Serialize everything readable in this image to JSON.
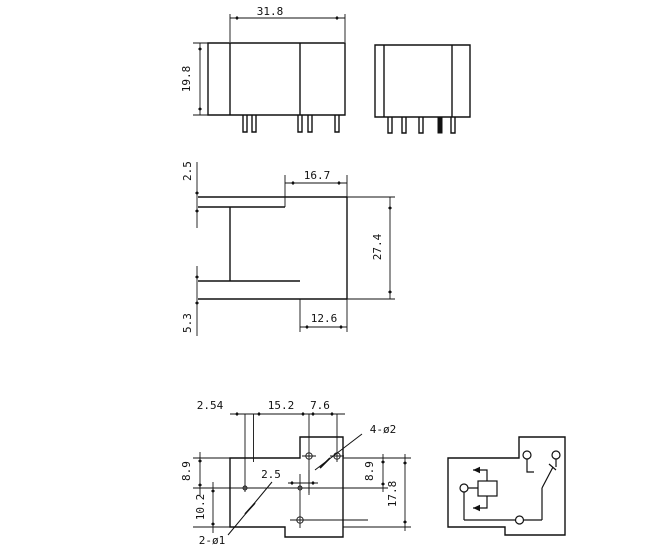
{
  "drawing": {
    "front_view": {
      "width": "31.8",
      "height": "19.8"
    },
    "profile_view": {
      "top_flange_thickness": "2.5",
      "top_width": "16.7",
      "depth": "27.4",
      "bottom_width": "12.6",
      "bottom_flange_thickness": "5.3"
    },
    "pcb_layout": {
      "pin_pitch": "2.54",
      "pin_span": "15.2",
      "hole_span": "7.6",
      "mounting_holes_note": "4-ø2",
      "pin_holes_note": "2-ø1",
      "offset": "2.5",
      "left_upper": "8.9",
      "left_lower": "10.2",
      "right_upper": "8.9",
      "right_total": "17.8"
    }
  }
}
